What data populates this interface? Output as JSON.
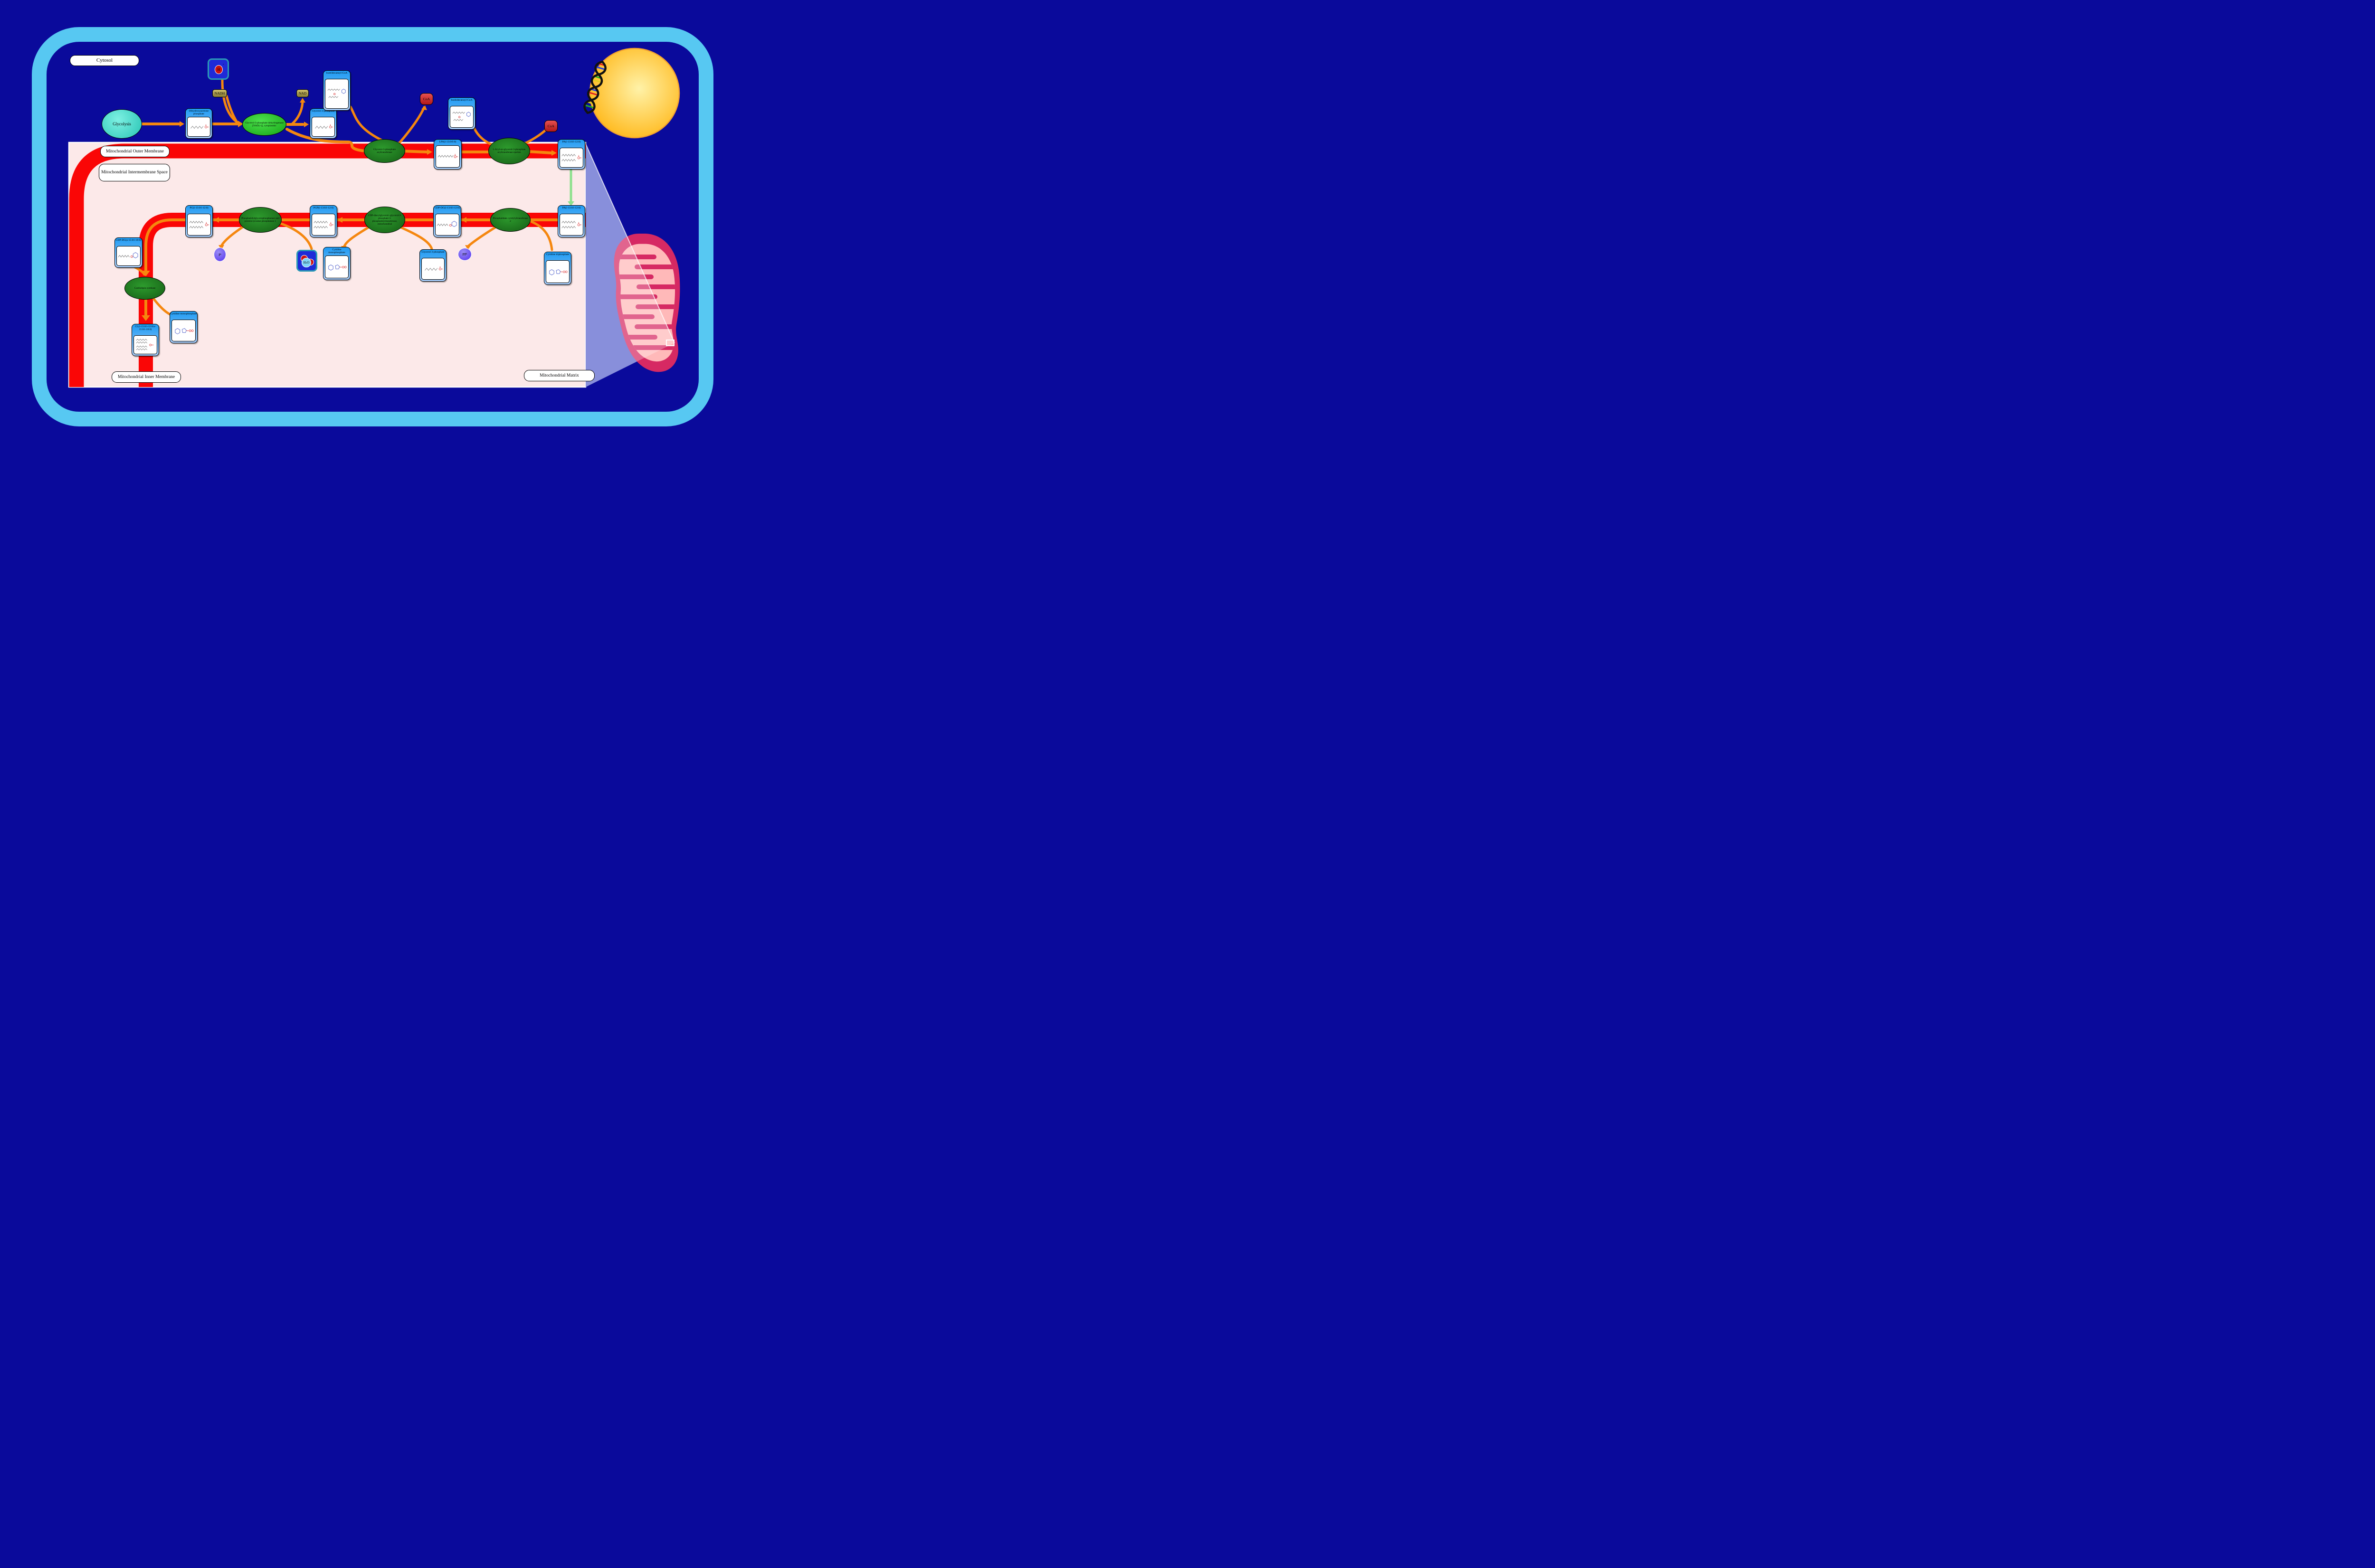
{
  "title": "Cardiolipin Biosynthesis pathway diagram",
  "compartments": {
    "cytosol": "Cytosol",
    "outer_membrane": "Mitochondrial Outer Membrane",
    "intermembrane_space": "Mitochondrial Intermembrane Space",
    "inner_membrane": "Mitochondrial Inner Membrane",
    "matrix": "Mitochondrial Matrix"
  },
  "process": {
    "glycolysis": "Glycolysis"
  },
  "metabolites": [
    {
      "id": "dhap",
      "label": "Dihydroxyacetone phosphate",
      "structure": "small"
    },
    {
      "id": "g3p_cytosol",
      "label": "Glycerol 3-phosphate",
      "structure": "small"
    },
    {
      "id": "isotridecanoyl_coa",
      "label": "Isotridecanoyl-CoA",
      "structure": "coa"
    },
    {
      "id": "isododecanoyl_coa",
      "label": "Isododecanoyl-CoA",
      "structure": "coa"
    },
    {
      "id": "lpa",
      "label": "LPA(i-13:0/0:0)",
      "structure": "lipid1"
    },
    {
      "id": "pa_outer",
      "label": "PA(i-13:0/i-12:0)",
      "structure": "lipid2"
    },
    {
      "id": "pa_inner",
      "label": "PA(i-13:0/i-12:0)",
      "structure": "lipid2"
    },
    {
      "id": "cdp_dg",
      "label": "CDP-DG(i-13:0/i-12:0)",
      "structure": "cdp"
    },
    {
      "id": "pgp",
      "label": "PGP(i-13:0/i-12:0)",
      "structure": "lipid2"
    },
    {
      "id": "pg",
      "label": "PG(i-13:0/i-12:0)",
      "structure": "lipid2"
    },
    {
      "id": "ctp",
      "label": "Cytidine triphosphate",
      "structure": "nuc"
    },
    {
      "id": "g3p_matrix",
      "label": "Glycerol 3-phosphate",
      "structure": "small"
    },
    {
      "id": "cmp_1",
      "label": "Cytidine monophosphate",
      "structure": "nuc"
    },
    {
      "id": "cdp_dg_a",
      "label": "CDP-DG(a-15:0/i-18:0)",
      "structure": "cdp"
    },
    {
      "id": "cmp_2",
      "label": "Cytidine monophosphate",
      "structure": "nuc"
    },
    {
      "id": "cl",
      "label": "CL(i-13:0/i-12:0/a-15:0/i-18:0)",
      "structure": "cl"
    }
  ],
  "enzymes": [
    {
      "id": "gpd1",
      "label": "Glycerol-3-phosphate dehydrogenase [NAD(+)], cytoplasmic",
      "variant": "bright"
    },
    {
      "id": "gpat",
      "label": "Glycerol-3-phosphate acyltransferase",
      "variant": "dark"
    },
    {
      "id": "agpat_epsilon",
      "label": "1-Acyl-sn-glycerol-3-phosphate acyltransferase epsilon",
      "variant": "dark"
    },
    {
      "id": "pcyt2",
      "label": "Phosphatidate cytidylyltransferase 2",
      "variant": "dark"
    },
    {
      "id": "pgs1",
      "label": "CDP-diacylglycerol--glycerol-3-phosphate 3-phosphatidyltransferase, mitochondrial",
      "variant": "dark"
    },
    {
      "id": "ptpmt1",
      "label": "Phosphatidylglycerophosphatase and protein-tyrosine phosphatase 1",
      "variant": "dark"
    },
    {
      "id": "crls1",
      "label": "Cardiolipin synthase",
      "variant": "dark"
    }
  ],
  "cofactors": {
    "nadh": {
      "label": "NADH"
    },
    "nad": {
      "label": "NAD"
    },
    "coa_1": {
      "label": "CoA"
    },
    "coa_2": {
      "label": "CoA"
    },
    "h_plus": {
      "label": "H",
      "sup": "+"
    },
    "h2o": {
      "label": "H",
      "sub": "2",
      "tail": "O"
    },
    "pi": {
      "label": "P",
      "sub": "i"
    },
    "ppi": {
      "label": "PP",
      "sub": "i"
    }
  },
  "colors": {
    "background_navy": "#0a0a9b",
    "cell_border_blue": "#57c8f2",
    "membrane_red": "#fa0606",
    "compartment_pink": "#fce9e9",
    "arrow_orange": "#f5870f",
    "transport_arrow_green": "#8ee08e",
    "metabolite_node_blue": "#1e9bf3",
    "enzyme_green": "#1e7a1e",
    "nucleus_yellow": "#ffb410",
    "mitochondrion_crimson": "#d62963",
    "zoom_wedge_purple": "#5a64cd"
  }
}
